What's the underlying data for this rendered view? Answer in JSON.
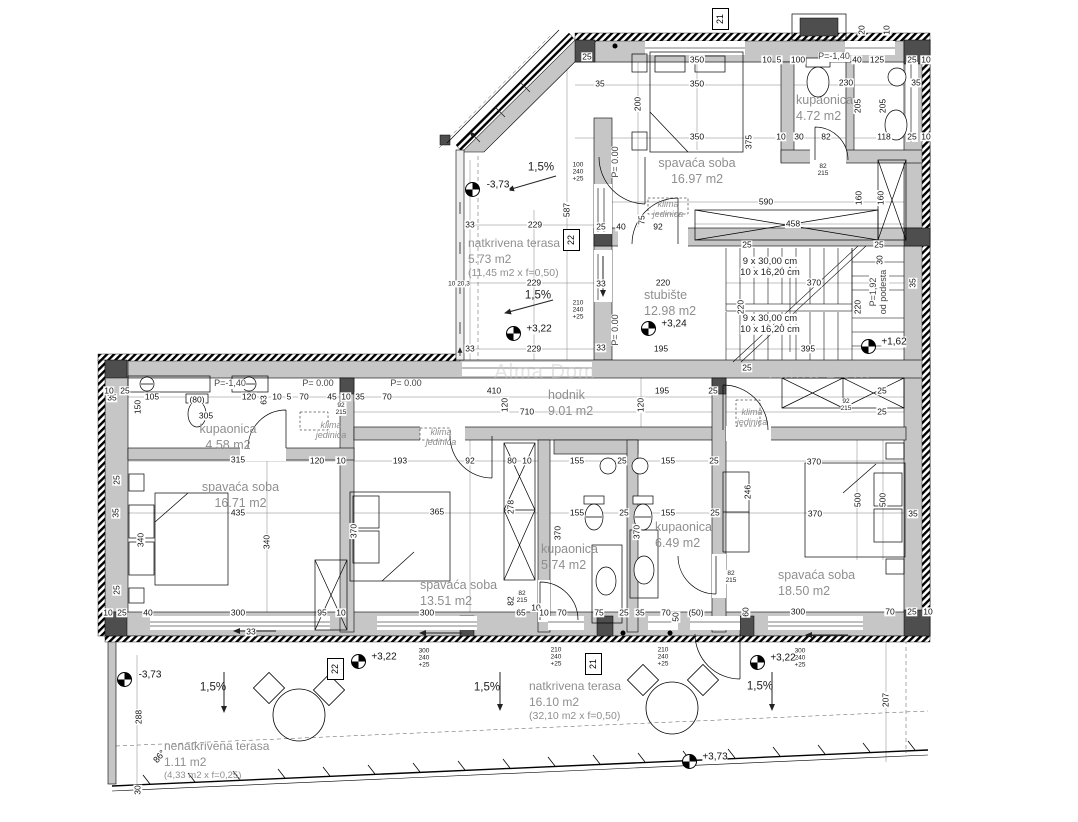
{
  "watermark": "Alma Dom",
  "rooms": [
    {
      "name": "spavaća soba",
      "area": "16.97 m2"
    },
    {
      "name": "kupaonica",
      "area": "4.72 m2"
    },
    {
      "name": "natkrivena terasa",
      "area": "5.73 m2",
      "note": "(11,45 m2 x f=0,50)"
    },
    {
      "name": "stubište",
      "area": "12.98 m2"
    },
    {
      "name": "hodnik",
      "area": "9.01 m2"
    },
    {
      "name": "kupaonica",
      "area": "4.58 m2"
    },
    {
      "name": "spavaća soba",
      "area": "16.71 m2"
    },
    {
      "name": "spavaća soba",
      "area": "13.51 m2"
    },
    {
      "name": "kupaonica",
      "area": "5.74 m2"
    },
    {
      "name": "kupaonica",
      "area": "6.49 m2"
    },
    {
      "name": "spavaća soba",
      "area": "18.50 m2"
    },
    {
      "name": "natkrivena terasa",
      "area": "16.10 m2",
      "note": "(32,10 m2 x f=0,50)"
    },
    {
      "name": "nenatkrivena terasa",
      "area": "1.11 m2",
      "note": "(4,33 m2 x f=0,25)"
    }
  ],
  "markers": [
    {
      "t": "21",
      "x": 712,
      "y": 8
    },
    {
      "t": "22",
      "x": 563,
      "y": 229
    },
    {
      "t": "21",
      "x": 585,
      "y": 653
    },
    {
      "t": "22",
      "x": 327,
      "y": 658
    }
  ],
  "elevations": [
    {
      "t": "-3,73",
      "x": 472,
      "y": 189
    },
    {
      "t": "+3,22",
      "x": 513,
      "y": 333
    },
    {
      "t": "+3,24",
      "x": 648,
      "y": 328
    },
    {
      "t": "+1,62",
      "x": 868,
      "y": 346
    },
    {
      "t": "-3,73",
      "x": 124,
      "y": 679
    },
    {
      "t": "+3,22",
      "x": 358,
      "y": 661
    },
    {
      "t": "+3,22",
      "x": 757,
      "y": 662
    },
    {
      "t": "+3,73",
      "x": 689,
      "y": 761
    }
  ],
  "dim_labels": [
    {
      "t": "25",
      "x": 587,
      "y": 57
    },
    {
      "t": "350",
      "x": 697,
      "y": 60
    },
    {
      "t": "10",
      "x": 767,
      "y": 60
    },
    {
      "t": "5",
      "x": 779,
      "y": 60
    },
    {
      "t": "100",
      "x": 798,
      "y": 60
    },
    {
      "t": "P=-1,40",
      "x": 834,
      "y": 57,
      "c": "lvl"
    },
    {
      "t": "40",
      "x": 857,
      "y": 60
    },
    {
      "t": "125",
      "x": 877,
      "y": 60
    },
    {
      "t": "25",
      "x": 912,
      "y": 60
    },
    {
      "t": "10",
      "x": 926,
      "y": 60
    },
    {
      "t": "35",
      "x": 600,
      "y": 84
    },
    {
      "t": "350",
      "x": 697,
      "y": 84
    },
    {
      "t": "230",
      "x": 846,
      "y": 83
    },
    {
      "t": "35",
      "x": 916,
      "y": 83
    },
    {
      "t": "200",
      "x": 638,
      "y": 104,
      "c": "dimr"
    },
    {
      "t": "350",
      "x": 697,
      "y": 137
    },
    {
      "t": "375",
      "x": 749,
      "y": 142,
      "c": "dimr"
    },
    {
      "t": "10",
      "x": 781,
      "y": 137
    },
    {
      "t": "30",
      "x": 799,
      "y": 137
    },
    {
      "t": "82",
      "x": 826,
      "y": 137
    },
    {
      "t": "118",
      "x": 884,
      "y": 137
    },
    {
      "t": "25",
      "x": 912,
      "y": 137
    },
    {
      "t": "10",
      "x": 926,
      "y": 137
    },
    {
      "t": "205",
      "x": 858,
      "y": 106,
      "c": "dimr"
    },
    {
      "t": "205",
      "x": 883,
      "y": 106,
      "c": "dimr"
    },
    {
      "t": "82\n215",
      "x": 823,
      "y": 170,
      "c": "stack2"
    },
    {
      "t": "100\n240\n+25",
      "x": 578,
      "y": 172,
      "c": "stack"
    },
    {
      "t": "587",
      "x": 567,
      "y": 210,
      "c": "dimr"
    },
    {
      "t": "P= 0.00",
      "x": 616,
      "y": 162,
      "c": "lvlr"
    },
    {
      "t": "75",
      "x": 642,
      "y": 220,
      "c": "dimr"
    },
    {
      "t": "92",
      "x": 658,
      "y": 227
    },
    {
      "t": "40",
      "x": 621,
      "y": 227
    },
    {
      "t": "25",
      "x": 601,
      "y": 227
    },
    {
      "t": "590",
      "x": 766,
      "y": 202
    },
    {
      "t": "458",
      "x": 793,
      "y": 224
    },
    {
      "t": "160",
      "x": 859,
      "y": 198,
      "c": "dimr"
    },
    {
      "t": "160",
      "x": 881,
      "y": 198,
      "c": "dimr"
    },
    {
      "t": "220",
      "x": 663,
      "y": 283
    },
    {
      "t": "220",
      "x": 741,
      "y": 307,
      "c": "dimr"
    },
    {
      "t": "220",
      "x": 858,
      "y": 307,
      "c": "dimr"
    },
    {
      "t": "370",
      "x": 814,
      "y": 283
    },
    {
      "t": "395",
      "x": 808,
      "y": 349
    },
    {
      "t": "195",
      "x": 661,
      "y": 349
    },
    {
      "t": "160",
      "x": 880,
      "y": 307,
      "c": "dimr"
    },
    {
      "t": "30",
      "x": 880,
      "y": 260,
      "c": "dimr"
    },
    {
      "t": "35",
      "x": 913,
      "y": 283,
      "c": "dimr"
    },
    {
      "t": "25",
      "x": 747,
      "y": 245
    },
    {
      "t": "25",
      "x": 747,
      "y": 368
    },
    {
      "t": "25",
      "x": 879,
      "y": 245
    },
    {
      "t": "9 x 30,00 cm",
      "x": 770,
      "y": 262,
      "c": "note"
    },
    {
      "t": "10 x 16,20 cm",
      "x": 770,
      "y": 273,
      "c": "note"
    },
    {
      "t": "9 x 30,00 cm",
      "x": 770,
      "y": 319,
      "c": "note"
    },
    {
      "t": "10 x 16,20 cm",
      "x": 770,
      "y": 330,
      "c": "note"
    },
    {
      "t": "P=1,92\nod podesta",
      "x": 879,
      "y": 292,
      "c": "lvlr"
    },
    {
      "t": "229",
      "x": 535,
      "y": 225
    },
    {
      "t": "33",
      "x": 470,
      "y": 225
    },
    {
      "t": "229",
      "x": 534,
      "y": 283
    },
    {
      "t": "33",
      "x": 601,
      "y": 284
    },
    {
      "t": "10 20,3",
      "x": 459,
      "y": 284,
      "c": "stack2"
    },
    {
      "t": "229",
      "x": 534,
      "y": 349
    },
    {
      "t": "33",
      "x": 470,
      "y": 349
    },
    {
      "t": "33",
      "x": 601,
      "y": 348
    },
    {
      "t": "1,5%",
      "x": 541,
      "y": 168,
      "c": "slope"
    },
    {
      "t": "1,5%",
      "x": 538,
      "y": 296,
      "c": "slope"
    },
    {
      "t": "210\n240\n+25",
      "x": 578,
      "y": 310,
      "c": "stack"
    },
    {
      "t": "P= 0.00",
      "x": 616,
      "y": 330,
      "c": "lvlr"
    },
    {
      "t": "klima\njedinica",
      "x": 668,
      "y": 210,
      "c": "klima"
    },
    {
      "t": "20",
      "x": 862,
      "y": 30,
      "c": "dimr"
    },
    {
      "t": "10",
      "x": 887,
      "y": 30,
      "c": "dimr"
    },
    {
      "t": "105",
      "x": 152,
      "y": 397
    },
    {
      "t": "(80)",
      "x": 197,
      "y": 400
    },
    {
      "t": "120",
      "x": 249,
      "y": 397
    },
    {
      "t": "P=-1,40",
      "x": 230,
      "y": 384,
      "c": "lvl"
    },
    {
      "t": "P= 0.00",
      "x": 318,
      "y": 384,
      "c": "lvl"
    },
    {
      "t": "P= 0.00",
      "x": 406,
      "y": 384,
      "c": "lvl"
    },
    {
      "t": "63",
      "x": 264,
      "y": 400,
      "c": "dimr"
    },
    {
      "t": "10",
      "x": 277,
      "y": 397
    },
    {
      "t": "5",
      "x": 289,
      "y": 397
    },
    {
      "t": "70",
      "x": 304,
      "y": 397
    },
    {
      "t": "45",
      "x": 332,
      "y": 397
    },
    {
      "t": "10",
      "x": 346,
      "y": 397
    },
    {
      "t": "35",
      "x": 360,
      "y": 397
    },
    {
      "t": "70",
      "x": 387,
      "y": 397
    },
    {
      "t": "92\n215",
      "x": 341,
      "y": 409,
      "c": "stack2"
    },
    {
      "t": "410",
      "x": 494,
      "y": 391
    },
    {
      "t": "710",
      "x": 527,
      "y": 412
    },
    {
      "t": "120",
      "x": 505,
      "y": 405,
      "c": "dimr"
    },
    {
      "t": "195",
      "x": 662,
      "y": 391
    },
    {
      "t": "120",
      "x": 641,
      "y": 405,
      "c": "dimr"
    },
    {
      "t": "25",
      "x": 713,
      "y": 391
    },
    {
      "t": "92\n215",
      "x": 846,
      "y": 405,
      "c": "stack2"
    },
    {
      "t": "25",
      "x": 882,
      "y": 391
    },
    {
      "t": "25",
      "x": 882,
      "y": 412
    },
    {
      "t": "klima\njedinica",
      "x": 331,
      "y": 431,
      "c": "klima"
    },
    {
      "t": "klima\njedinica",
      "x": 441,
      "y": 438,
      "c": "klima"
    },
    {
      "t": "klima\njedinica",
      "x": 752,
      "y": 418,
      "c": "klima"
    },
    {
      "t": "305",
      "x": 206,
      "y": 416
    },
    {
      "t": "150",
      "x": 138,
      "y": 407,
      "c": "dimr"
    },
    {
      "t": "35",
      "x": 112,
      "y": 398
    },
    {
      "t": "25",
      "x": 125,
      "y": 391
    },
    {
      "t": "10",
      "x": 109,
      "y": 391
    },
    {
      "t": "315",
      "x": 238,
      "y": 460
    },
    {
      "t": "120",
      "x": 317,
      "y": 461
    },
    {
      "t": "10",
      "x": 341,
      "y": 461
    },
    {
      "t": "193",
      "x": 400,
      "y": 461
    },
    {
      "t": "92",
      "x": 470,
      "y": 461
    },
    {
      "t": "80",
      "x": 512,
      "y": 461
    },
    {
      "t": "10",
      "x": 527,
      "y": 461
    },
    {
      "t": "155",
      "x": 577,
      "y": 461
    },
    {
      "t": "25",
      "x": 622,
      "y": 461
    },
    {
      "t": "155",
      "x": 668,
      "y": 461
    },
    {
      "t": "25",
      "x": 714,
      "y": 461
    },
    {
      "t": "370",
      "x": 814,
      "y": 462
    },
    {
      "t": "435",
      "x": 238,
      "y": 513
    },
    {
      "t": "340",
      "x": 141,
      "y": 540,
      "c": "dimr"
    },
    {
      "t": "340",
      "x": 267,
      "y": 542,
      "c": "dimr"
    },
    {
      "t": "365",
      "x": 437,
      "y": 512
    },
    {
      "t": "370",
      "x": 354,
      "y": 531,
      "c": "dimr"
    },
    {
      "t": "278",
      "x": 511,
      "y": 507,
      "c": "dimr"
    },
    {
      "t": "370",
      "x": 558,
      "y": 533,
      "c": "dimr"
    },
    {
      "t": "155",
      "x": 577,
      "y": 513
    },
    {
      "t": "25",
      "x": 624,
      "y": 513
    },
    {
      "t": "155",
      "x": 668,
      "y": 513
    },
    {
      "t": "25",
      "x": 715,
      "y": 513
    },
    {
      "t": "370",
      "x": 637,
      "y": 532,
      "c": "dimr"
    },
    {
      "t": "246",
      "x": 748,
      "y": 492,
      "c": "dimr"
    },
    {
      "t": "370",
      "x": 815,
      "y": 514
    },
    {
      "t": "500",
      "x": 858,
      "y": 500,
      "c": "dimr"
    },
    {
      "t": "500",
      "x": 883,
      "y": 500,
      "c": "dimr"
    },
    {
      "t": "35",
      "x": 913,
      "y": 514
    },
    {
      "t": "82\n215",
      "x": 522,
      "y": 597,
      "c": "stack2"
    },
    {
      "t": "82\n215",
      "x": 731,
      "y": 577,
      "c": "stack2"
    },
    {
      "t": "25",
      "x": 117,
      "y": 480,
      "c": "dimr"
    },
    {
      "t": "35",
      "x": 116,
      "y": 513,
      "c": "dimr"
    },
    {
      "t": "25",
      "x": 117,
      "y": 590,
      "c": "dimr"
    },
    {
      "t": "10",
      "x": 108,
      "y": 613
    },
    {
      "t": "25",
      "x": 122,
      "y": 613
    },
    {
      "t": "40",
      "x": 148,
      "y": 613
    },
    {
      "t": "300",
      "x": 238,
      "y": 613
    },
    {
      "t": "95",
      "x": 322,
      "y": 613
    },
    {
      "t": "10",
      "x": 341,
      "y": 613
    },
    {
      "t": "33",
      "x": 251,
      "y": 632
    },
    {
      "t": "300",
      "x": 427,
      "y": 613
    },
    {
      "t": "82",
      "x": 511,
      "y": 601,
      "c": "dimr"
    },
    {
      "t": "65",
      "x": 521,
      "y": 613
    },
    {
      "t": "10",
      "x": 536,
      "y": 608
    },
    {
      "t": "10",
      "x": 544,
      "y": 613
    },
    {
      "t": "70",
      "x": 562,
      "y": 613
    },
    {
      "t": "75",
      "x": 599,
      "y": 613
    },
    {
      "t": "25",
      "x": 624,
      "y": 613
    },
    {
      "t": "35",
      "x": 640,
      "y": 613
    },
    {
      "t": "70",
      "x": 666,
      "y": 613
    },
    {
      "t": "50",
      "x": 676,
      "y": 617,
      "c": "dimr"
    },
    {
      "t": "(50)",
      "x": 696,
      "y": 613
    },
    {
      "t": "60",
      "x": 746,
      "y": 612,
      "c": "dimr"
    },
    {
      "t": "300",
      "x": 798,
      "y": 612
    },
    {
      "t": "70",
      "x": 890,
      "y": 612
    },
    {
      "t": "25",
      "x": 912,
      "y": 612
    },
    {
      "t": "10",
      "x": 928,
      "y": 612
    },
    {
      "t": "300\n240\n+25",
      "x": 424,
      "y": 658,
      "c": "stack"
    },
    {
      "t": "210\n240\n+25",
      "x": 556,
      "y": 657,
      "c": "stack"
    },
    {
      "t": "210\n240\n+25",
      "x": 663,
      "y": 657,
      "c": "stack"
    },
    {
      "t": "300\n240\n+25",
      "x": 800,
      "y": 658,
      "c": "stack"
    },
    {
      "t": "1,5%",
      "x": 213,
      "y": 688,
      "c": "slope"
    },
    {
      "t": "1,5%",
      "x": 487,
      "y": 688,
      "c": "slope"
    },
    {
      "t": "1,5%",
      "x": 760,
      "y": 687,
      "c": "slope"
    },
    {
      "t": "288",
      "x": 139,
      "y": 717,
      "c": "dimr"
    },
    {
      "t": "30",
      "x": 138,
      "y": 790,
      "c": "dimr"
    },
    {
      "t": "86°",
      "x": 160,
      "y": 757,
      "c": "ang"
    },
    {
      "t": "207",
      "x": 886,
      "y": 700,
      "c": "dimr"
    },
    {
      "t": "Alma Dom",
      "x": 545,
      "y": 372,
      "c": "wm"
    },
    {
      "t": "Alma Dom",
      "x": 820,
      "y": 372,
      "c": "wm"
    }
  ]
}
